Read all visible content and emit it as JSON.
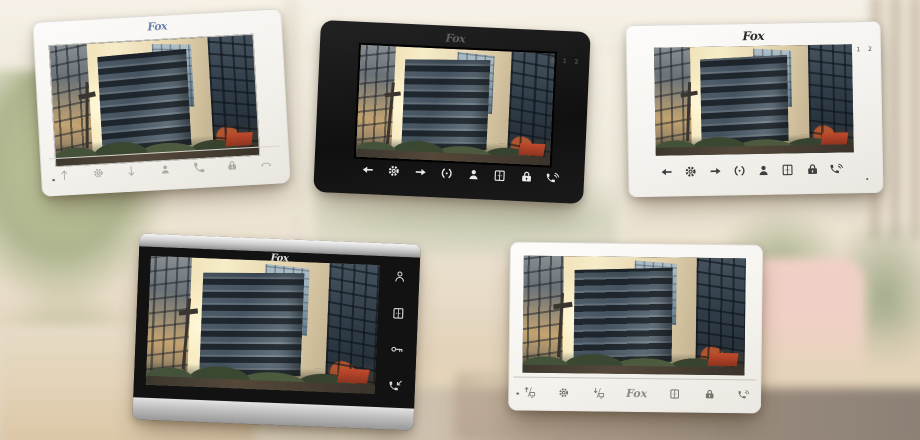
{
  "brand": "Fox",
  "screen_image": "modern glass office building at golden hour",
  "colors": {
    "frame_white": "#f6f3ee",
    "frame_black": "#161616",
    "frame_silver": "#c9c9c9",
    "logo_blue": "#6f83ad",
    "awning_red": "#b0402a"
  },
  "monitors": [
    {
      "model": "white landscape monitor with 7 front touch buttons",
      "frame": "white",
      "buttons": [
        "arrow-up",
        "gear",
        "arrow-down",
        "person",
        "phone",
        "lock",
        "hangup"
      ]
    },
    {
      "model": "black landscape monitor with 8 front touch buttons",
      "frame": "black",
      "indicators": "0 1 2",
      "buttons": [
        "arrow-left",
        "gear",
        "arrow-right",
        "intercom",
        "person",
        "door",
        "lock",
        "talk"
      ]
    },
    {
      "model": "white landscape monitor with 8 front touch buttons",
      "frame": "white",
      "indicators": "0 1 2",
      "buttons": [
        "arrow-left",
        "gear",
        "arrow-right",
        "intercom",
        "person",
        "door",
        "lock",
        "talk"
      ]
    },
    {
      "model": "silver and black monitor with side button column",
      "frame": "silver",
      "buttons": [
        "person-outline",
        "door",
        "key",
        "phone-arrow"
      ]
    },
    {
      "model": "white landscape monitor with logo in button row",
      "frame": "white",
      "buttons": [
        "monitor-up",
        "gear",
        "monitor-down",
        "logo",
        "door",
        "lock",
        "talk"
      ]
    }
  ]
}
